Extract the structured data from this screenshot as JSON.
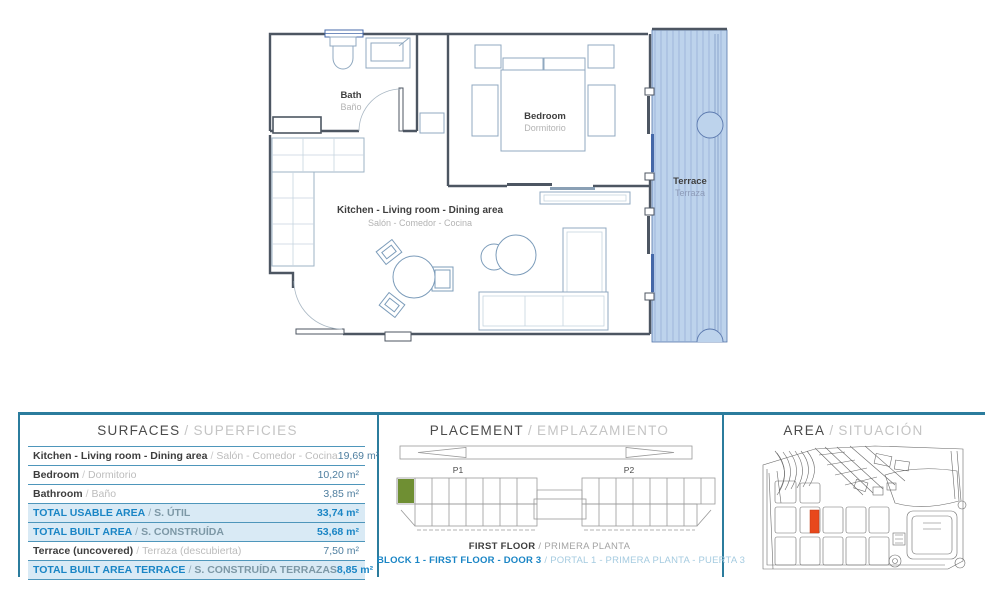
{
  "slash": "/",
  "plan": {
    "bath": {
      "en": "Bath",
      "es": "Baño"
    },
    "bedroom": {
      "en": "Bedroom",
      "es": "Dormitorio"
    },
    "living": {
      "en": "Kitchen - Living room - Dining area",
      "es": "Salón - Comedor - Cocina"
    },
    "terrace": {
      "en": "Terrace",
      "es": "Terraza"
    }
  },
  "surfaces": {
    "title": {
      "en": "SURFACES",
      "es": "SUPERFICIES"
    },
    "rows": [
      {
        "en": "Kitchen - Living room - Dining area",
        "es": "Salón - Comedor - Cocina",
        "value": "19,69 m²"
      },
      {
        "en": "Bedroom",
        "es": "Dormitorio",
        "value": "10,20 m²"
      },
      {
        "en": "Bathroom",
        "es": "Baño",
        "value": "3,85 m²"
      },
      {
        "en": "TOTAL USABLE AREA",
        "es": "S. ÚTIL",
        "value": "33,74 m²"
      },
      {
        "en": "TOTAL BUILT AREA",
        "es": "S. CONSTRUÍDA",
        "value": "53,68 m²"
      },
      {
        "en": "Terrace (uncovered)",
        "es": "Terraza (descubierta)",
        "value": "7,50 m²"
      },
      {
        "en": "TOTAL BUILT AREA TERRACE",
        "es": "S. CONSTRUÍDA TERRAZAS",
        "value": "8,85 m²"
      }
    ]
  },
  "placement": {
    "title": {
      "en": "PLACEMENT",
      "es": "EMPLAZAMIENTO"
    },
    "p1": "P1",
    "p2": "P2",
    "floor": {
      "en": "FIRST FLOOR",
      "es": "PRIMERA PLANTA"
    },
    "unit": {
      "en": "BLOCK 1 - FIRST FLOOR - DOOR 3",
      "es": "PORTAL 1 - PRIMERA PLANTA - PUERTA 3"
    }
  },
  "area": {
    "title": {
      "en": "AREA",
      "es": "SITUACIÓN"
    }
  },
  "colors": {
    "accent_teal": "#2b7c9d",
    "highlight_text_blue": "#1a85c5",
    "highlight_row_bg": "#d9eaf5",
    "terrace_fill": "#bdd3ec",
    "unit_green": "#6f8f33",
    "plot_orange": "#e8481c"
  }
}
